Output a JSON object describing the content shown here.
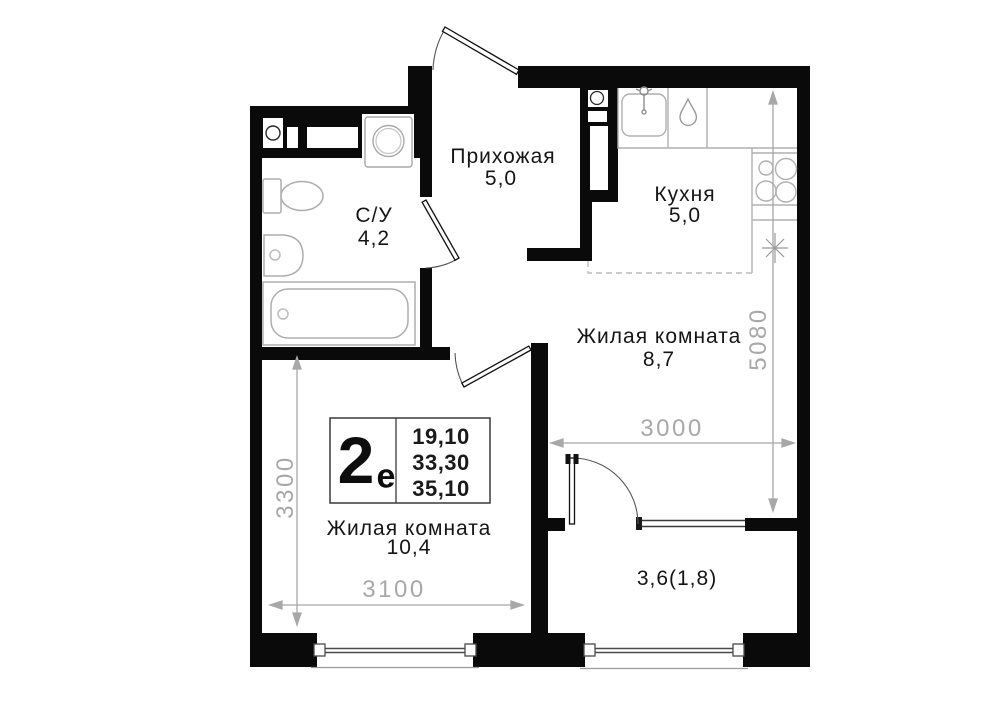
{
  "plan_title": "Floor plan 2e euro apartment",
  "rooms": {
    "hallway": {
      "name": "Прихожая",
      "area": "5,0"
    },
    "bathroom": {
      "name": "С/У",
      "area": "4,2"
    },
    "kitchen": {
      "name": "Кухня",
      "area": "5,0"
    },
    "living1": {
      "name": "Жилая комната",
      "area": "8,7"
    },
    "living2": {
      "name": "Жилая комната",
      "area": "10,4"
    },
    "balcony": {
      "area": "3,6(1,8)"
    }
  },
  "dimensions": {
    "living1_width": "3000",
    "living1_height": "5080",
    "living2_height": "3300",
    "living2_width": "3100"
  },
  "info": {
    "type": "2",
    "suffix": "е",
    "values": [
      "19,10",
      "33,30",
      "35,10"
    ]
  },
  "colors": {
    "wall": "#0a0a0a",
    "fixture": "#b0b0b0",
    "dimension": "#a8a8a8",
    "label": "#151515"
  }
}
